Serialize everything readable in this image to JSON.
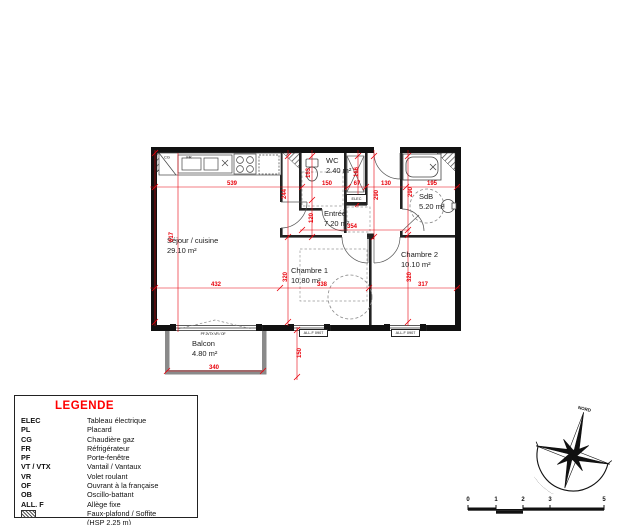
{
  "plan": {
    "rooms": [
      {
        "name": "Séjour / cuisine",
        "area": "29.10 m²"
      },
      {
        "name": "WC",
        "area": "2.40 m²"
      },
      {
        "name": "Entrée",
        "area": "7.20 m²"
      },
      {
        "name": "SdB",
        "area": "5.20 m²"
      },
      {
        "name": "Chambre 1",
        "area": "10.80 m²"
      },
      {
        "name": "Chambre 2",
        "area": "10.10 m²"
      },
      {
        "name": "Balcon",
        "area": "4.80 m²"
      }
    ],
    "dims": [
      "539",
      "150",
      "67",
      "130",
      "195",
      "617",
      "244",
      "163",
      "166",
      "290",
      "290",
      "120",
      "354",
      "320",
      "320",
      "432",
      "338",
      "317",
      "340",
      "150"
    ],
    "tags": {
      "elec_box": "ELEC",
      "allf_left": "ALL.F 0907",
      "allf_right": "ALL.F 0907",
      "balcony_door": "PF 2VTX VR / OF",
      "kitchen_left": "CG",
      "kitchen_right": "FR"
    }
  },
  "legend": {
    "title": "LEGENDE",
    "items": [
      {
        "abbr": "ELEC",
        "desc": "Tableau électrique"
      },
      {
        "abbr": "PL",
        "desc": "Placard"
      },
      {
        "abbr": "CG",
        "desc": "Chaudière gaz"
      },
      {
        "abbr": "FR",
        "desc": "Réfrigérateur"
      },
      {
        "abbr": "PF",
        "desc": "Porte-fenêtre"
      },
      {
        "abbr": "VT / VTX",
        "desc": "Vantail / Vantaux"
      },
      {
        "abbr": "VR",
        "desc": "Volet roulant"
      },
      {
        "abbr": "OF",
        "desc": "Ouvrant à la française"
      },
      {
        "abbr": "OB",
        "desc": "Oscillo-battant"
      },
      {
        "abbr": "ALL. F",
        "desc": "Allège fixe"
      }
    ],
    "hatch": {
      "line1": "Faux-plafond / Soffite",
      "line2": "(HSP 2,25 m)"
    }
  },
  "compass": {
    "north_label": "NORD",
    "arc_marks": "····················"
  },
  "scalebar": {
    "ticks": [
      "0",
      "1",
      "2",
      "3",
      "5"
    ]
  },
  "colors": {
    "dimension": "#e8000a",
    "legend_title": "#ff0000",
    "wall": "#111111"
  }
}
